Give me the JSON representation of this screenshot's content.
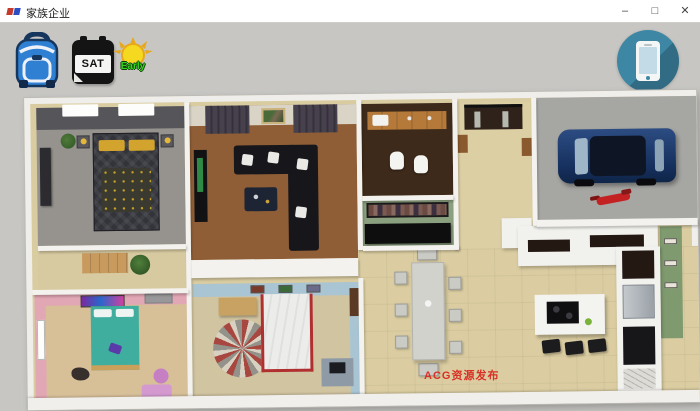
{
  "window": {
    "title": "家族企业",
    "controls": {
      "minimize": "–",
      "maximize": "□",
      "close": "✕"
    }
  },
  "hud": {
    "backpack": {
      "icon": "backpack-icon",
      "color": "#2f80d2"
    },
    "calendar": {
      "icon": "calendar-icon",
      "day": "SAT"
    },
    "time_of_day": {
      "icon": "sun-icon",
      "label": "Early",
      "color": "#35d41c"
    },
    "phone": {
      "icon": "phone-icon",
      "color": "#3d87a4"
    }
  },
  "watermark": {
    "text": "ACG资源发布",
    "color": "#d93025"
  },
  "scene": {
    "view": "isometric-house-floorplan",
    "background_color": "#c7c6c3",
    "rooms": [
      {
        "name": "master-bedroom",
        "floor_color": "#96938e",
        "furniture": [
          "double-bed",
          "nightstand-lamps",
          "dresser",
          "plant"
        ]
      },
      {
        "name": "living-room",
        "floor_color": "#8f5e36",
        "furniture": [
          "sectional-sofa",
          "coffee-table",
          "tv-stand",
          "wall-photo",
          "curtains"
        ]
      },
      {
        "name": "bathroom",
        "floor_color": "#3e2a1a",
        "furniture": [
          "wood-vanity-sink",
          "toilets"
        ]
      },
      {
        "name": "closet",
        "floor_color": "#8ba07f",
        "furniture": [
          "wardrobe-rack",
          "black-cabinet"
        ]
      },
      {
        "name": "entry-hall",
        "floor_color": "#ddcfa4",
        "furniture": [
          "front-double-door"
        ]
      },
      {
        "name": "garage",
        "floor_color": "#a6a6a3",
        "furniture": [
          "blue-car",
          "red-motorcycle"
        ]
      },
      {
        "name": "hallway",
        "floor_color": "#d7caa0",
        "furniture": [
          "plant",
          "mat"
        ]
      },
      {
        "name": "kids-bedroom-pink",
        "floor_color": "#d7bf98",
        "wall_color": "#e2a7b4",
        "furniture": [
          "teal-bed",
          "poster",
          "window",
          "ottoman",
          "bin"
        ]
      },
      {
        "name": "bedroom-blue",
        "floor_color": "#d1c4a0",
        "wall_color": "#a9c5d3",
        "furniture": [
          "white-red-bed",
          "striped-rug",
          "wood-desk",
          "computer-desk"
        ]
      },
      {
        "name": "dining-kitchen",
        "floor_color": "#dbcda1",
        "accent_wall_color": "#7f9a6f",
        "furniture": [
          "dining-table",
          "eight-chairs",
          "l-counter",
          "fridge",
          "oven",
          "island-cooktop",
          "bar-stools"
        ]
      }
    ]
  }
}
